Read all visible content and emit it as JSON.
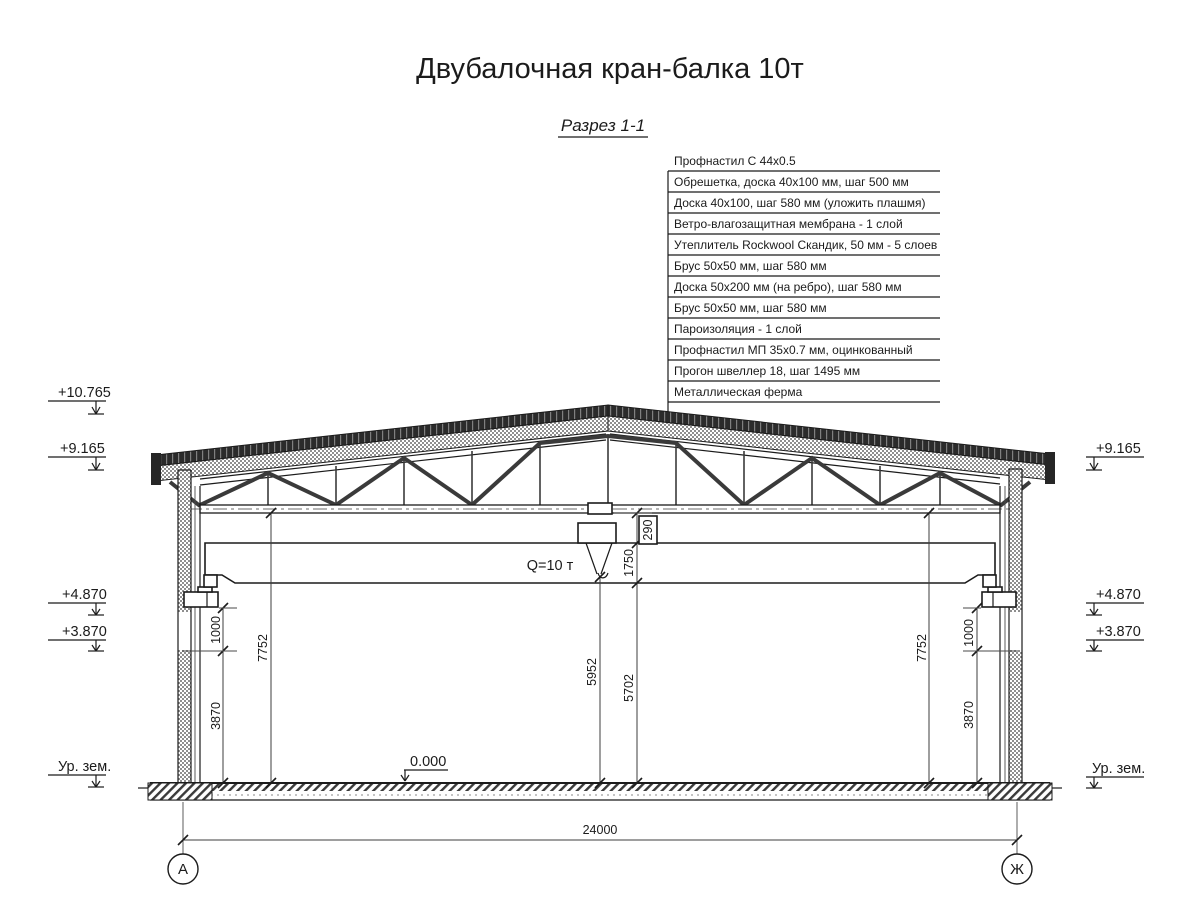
{
  "title": "Двубалочная кран-балка 10т",
  "view_label": "Разрез 1-1",
  "roof_callouts": [
    "Профнастил С 44х0.5",
    "Обрешетка, доска 40х100 мм, шаг 500 мм",
    "Доска 40х100, шаг 580 мм (уложить плашмя)",
    "Ветро-влагозащитная мембрана - 1 слой",
    "Утеплитель Rockwool Скандик, 50 мм - 5 слоев",
    "Брус 50х50 мм, шаг 580 мм",
    "Доска 50х200 мм (на ребро), шаг 580 мм",
    "Брус 50х50 мм, шаг 580 мм",
    "Пароизоляция - 1 слой",
    "Профнастил МП 35х0.7 мм, оцинкованный",
    "Прогон швеллер 18, шаг 1495 мм",
    "Металлическая ферма"
  ],
  "crane": {
    "capacity": "Q=10 т"
  },
  "elevation_marks": {
    "left": {
      "e10765": "+10.765",
      "e9165": "+9.165",
      "e4870": "+4.870",
      "e3870": "+3.870",
      "ground": "Ур. зем."
    },
    "right": {
      "e9165": "+9.165",
      "e4870": "+4.870",
      "e3870": "+3.870",
      "ground": "Ур. зем."
    },
    "floor": "0.000"
  },
  "dimensions": {
    "span": "24000",
    "truss_to_girder": "290",
    "girder_to_hook": "1750",
    "hook_to_floor": "5952",
    "girder_bottom_to_floor": "5702",
    "left_clearance": "7752",
    "left_corbel": "1000",
    "left_under_corbel": "3870",
    "right_clearance": "7752",
    "right_corbel": "1000",
    "right_under_corbel": "3870"
  },
  "axes": {
    "left": "А",
    "right": "Ж"
  },
  "colors": {
    "line": "#1b1b1b",
    "roof_dark": "#2b2b2b",
    "hatch_grey": "#8f8f8f",
    "background": "#ffffff"
  }
}
